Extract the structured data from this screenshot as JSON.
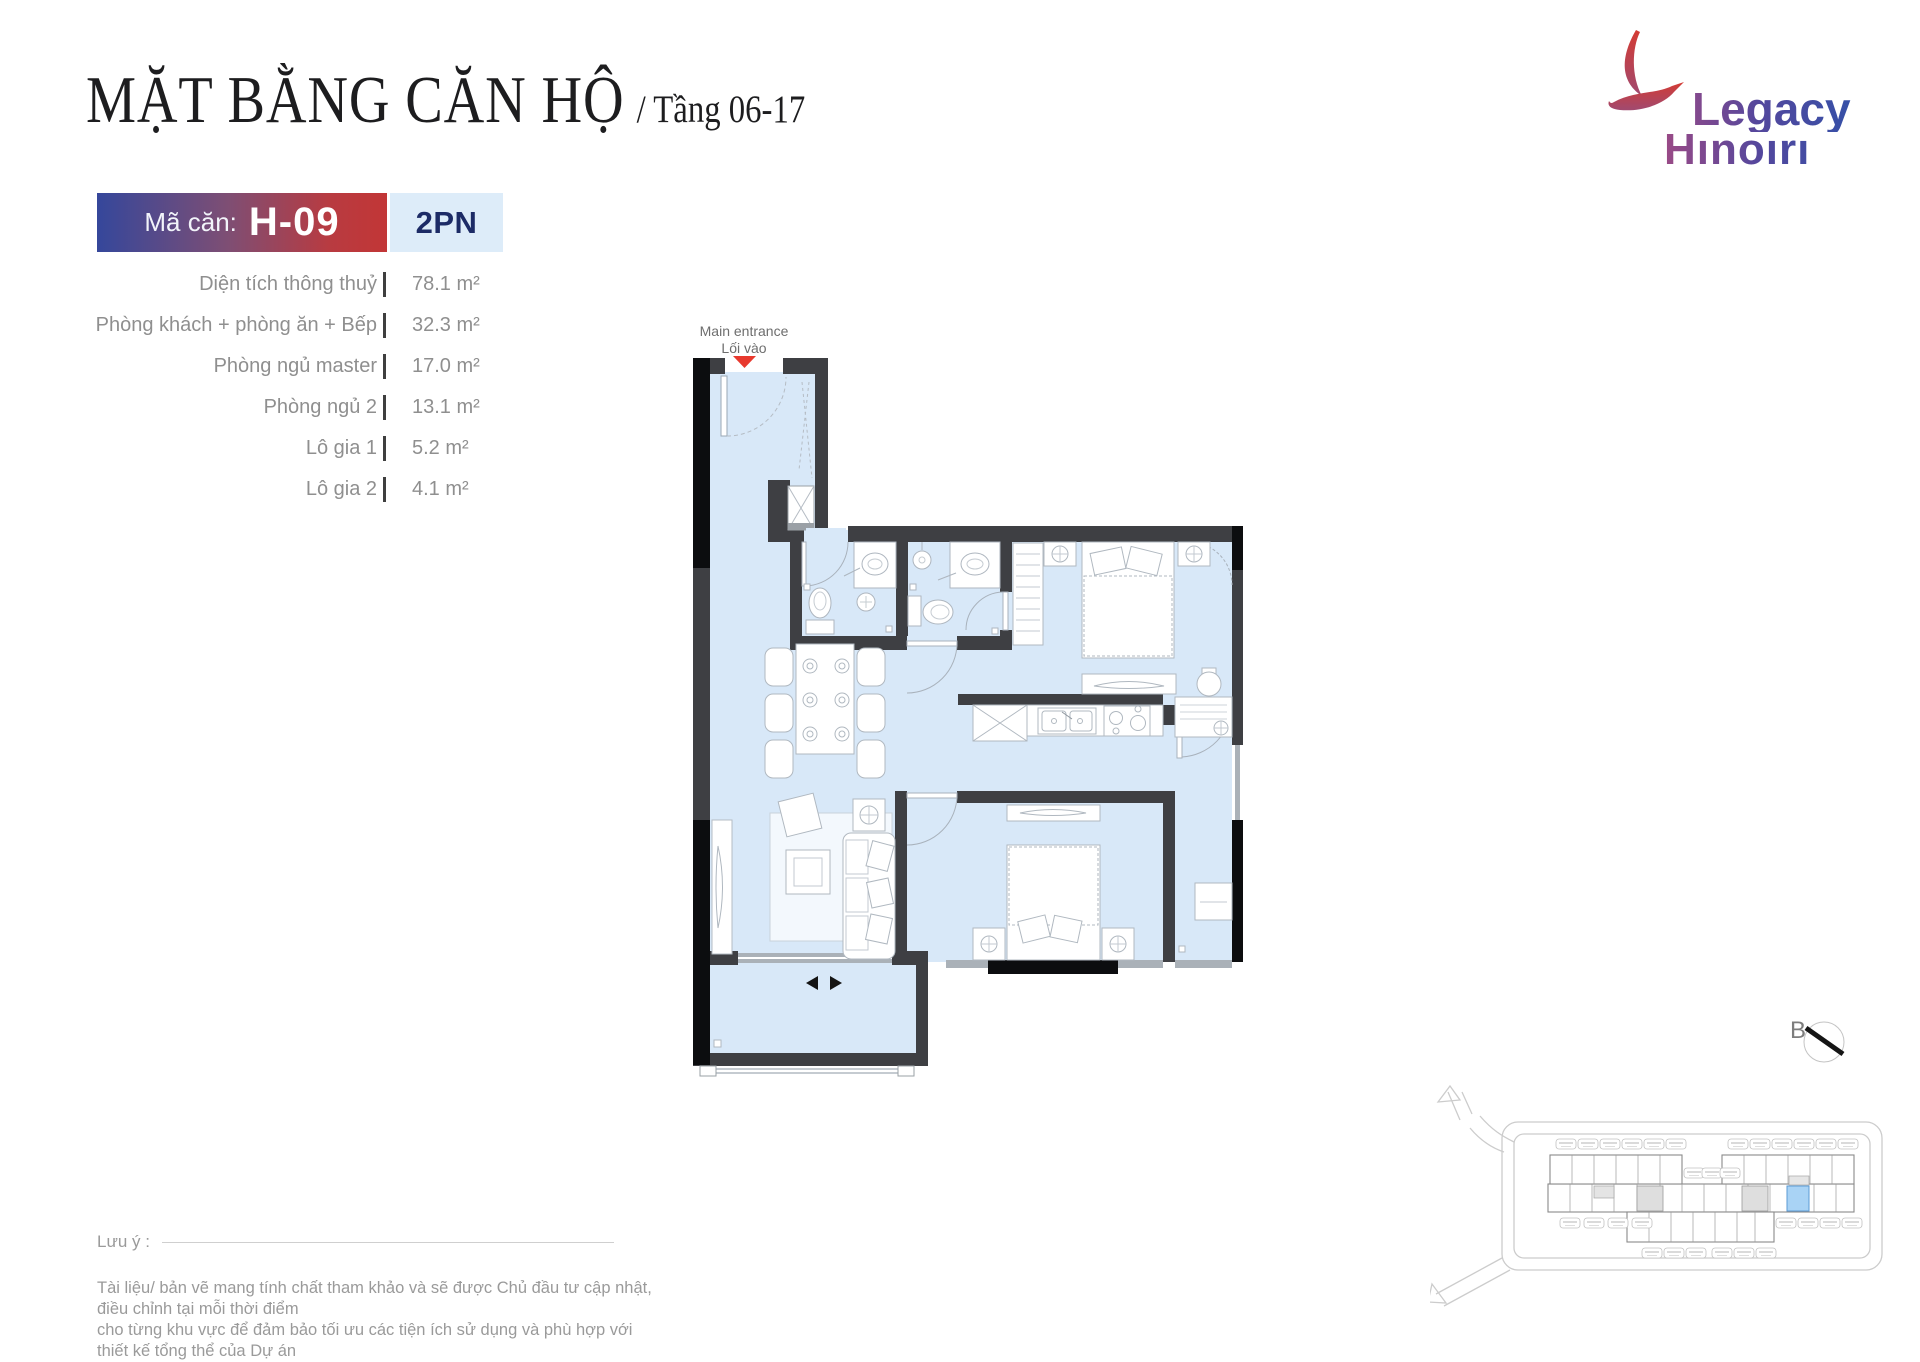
{
  "header": {
    "title": "MẶT BẰNG CĂN HỘ",
    "subtitle": "/ Tầng 06-17"
  },
  "logo": {
    "line1": "Legacy",
    "line2": "Hınoırı"
  },
  "badge": {
    "label": "Mã căn:",
    "code": "H-09",
    "type": "2PN"
  },
  "specs": [
    {
      "label": "Diện tích thông thuỷ",
      "value": "78.1 m²"
    },
    {
      "label": "Phòng khách + phòng ăn + Bếp",
      "value": "32.3 m²"
    },
    {
      "label": "Phòng ngủ master",
      "value": "17.0 m²"
    },
    {
      "label": "Phòng ngủ 2",
      "value": "13.1 m²"
    },
    {
      "label": "Lô gia 1",
      "value": "5.2 m²"
    },
    {
      "label": "Lô gia 2",
      "value": "4.1 m²"
    }
  ],
  "plan": {
    "entrance_en": "Main entrance",
    "entrance_vi": "Lối vào"
  },
  "compass": {
    "label": "B"
  },
  "footer": {
    "note_label": "Lưu ý :",
    "line1": "Tài liệu/ bản vẽ mang tính chất tham khảo và sẽ được Chủ đầu tư cập nhật, điều chỉnh tại mỗi thời điểm",
    "line2": "cho từng khu vực để đảm bảo tối ưu các tiện ích sử dụng và phù hợp với thiết kế tổng thể của Dự án"
  },
  "colors": {
    "accent_red": "#c23636",
    "accent_blue": "#35479b",
    "floor_blue": "#d8e8f8",
    "wall": "#3e3f43",
    "entrance_marker": "#e8392e",
    "unit_highlight": "#a9d3f5",
    "type_bg": "#ddecf9",
    "type_text": "#1c2b66"
  }
}
